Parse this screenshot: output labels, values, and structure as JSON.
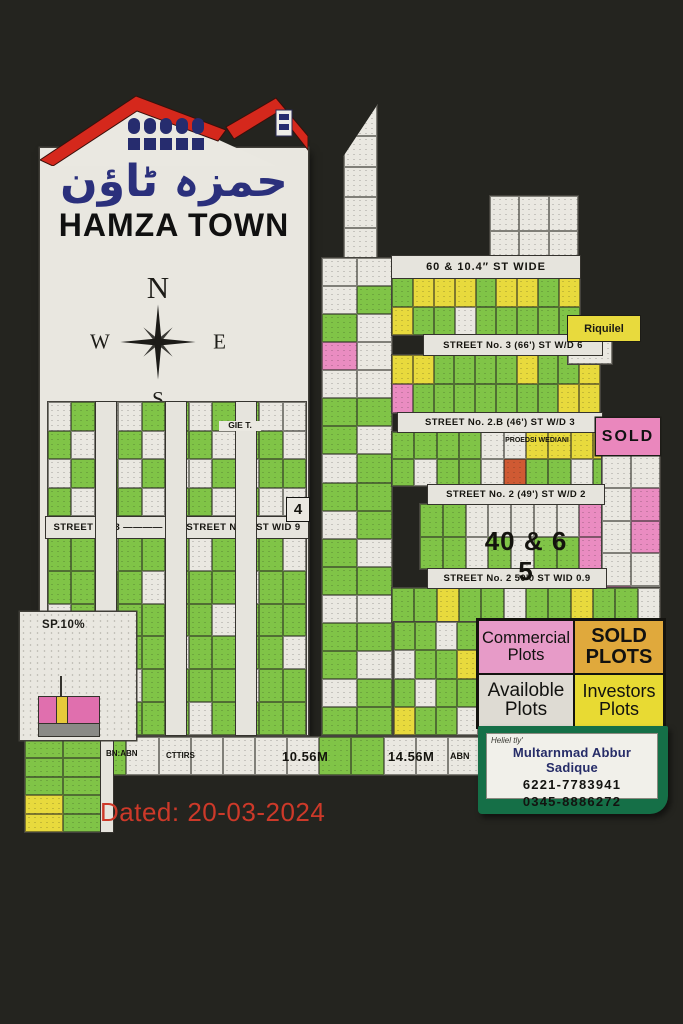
{
  "poster": {
    "dated": "Dated: 20-03-2024"
  },
  "logo": {
    "urdu": "حمزہ ٹاؤن",
    "title": "HAMZA TOWN"
  },
  "compass": {
    "n": "N",
    "e": "E",
    "s": "S",
    "w": "W"
  },
  "legend": {
    "commercial": "Commercial Plots",
    "sold": "SOLD PLOTS",
    "available": "Availoble Plots",
    "investors": "Investors Plots"
  },
  "sold_badge": "SOLD",
  "riquilel_label": "Riquilel",
  "sp10_label": "SP.10%",
  "contact": {
    "heading": "Heliel tly'",
    "name": "Multarnmad Abbur Sadique",
    "phone1": "6221-7783941",
    "phone2": "0345-8886272"
  },
  "palette": {
    "background": "#24241f",
    "paper": "#e9e7e0",
    "green_plot": "#80c447",
    "yellow_plot": "#e8da3d",
    "pink_plot": "#ea8cc1",
    "white_plot": "#eae8e1",
    "orange_red_plot": "#cf5a33",
    "legend_commercial_bg": "#e79bc8",
    "legend_sold_bg": "#e0a93c",
    "legend_available_bg": "#dedbd3",
    "legend_investors_bg": "#e8da33",
    "contact_green": "#156f47",
    "roof_red": "#d5281c",
    "logo_navy": "#2b307c",
    "dated_red": "#cd3929"
  },
  "street_bands": [
    {
      "name": "street-no3-band",
      "x": 46,
      "y": 517,
      "w": 262,
      "h": 21,
      "labels": [
        "STREET NO.3 ———— 8",
        "STREET NO.3  ST WID 9"
      ]
    },
    {
      "name": "street-60ft-band",
      "x": 392,
      "y": 256,
      "w": 188,
      "h": 22,
      "fs": 11,
      "labels": [
        "60 & 10.4″  ST WIDE"
      ]
    },
    {
      "name": "street-no3-66-band",
      "x": 424,
      "y": 335,
      "w": 178,
      "h": 20,
      "labels": [
        "STREET No. 3 (66')   ST W/D 6"
      ]
    },
    {
      "name": "street-no2b-band",
      "x": 398,
      "y": 413,
      "w": 204,
      "h": 19,
      "labels": [
        "STREET No. 2.B (46')   ST W/D 3"
      ]
    },
    {
      "name": "street-no2-band",
      "x": 428,
      "y": 485,
      "w": 176,
      "h": 19,
      "labels": [
        "STREET No. 2 (49')   ST W/D 2"
      ]
    },
    {
      "name": "street-no2-50-band",
      "x": 428,
      "y": 569,
      "w": 178,
      "h": 19,
      "labels": [
        "STREET No. 2 50'0   ST WID 0.9"
      ]
    },
    {
      "name": "left-vertical-street-1",
      "x": 96,
      "y": 402,
      "w": 20,
      "h": 333,
      "vertical": true,
      "labels": []
    },
    {
      "name": "left-vertical-street-2",
      "x": 166,
      "y": 402,
      "w": 20,
      "h": 333,
      "vertical": true,
      "labels": []
    },
    {
      "name": "left-vertical-street-3",
      "x": 236,
      "y": 402,
      "w": 20,
      "h": 333,
      "vertical": true,
      "labels": []
    },
    {
      "name": "bottom-left-street",
      "x": 101,
      "y": 740,
      "w": 12,
      "h": 92,
      "vertical": true,
      "labels": []
    }
  ],
  "float_labels": [
    {
      "name": "label-proposed-wedian",
      "text": "PROEDSI WEDIANI",
      "x": 498,
      "y": 437,
      "w": 78,
      "fs": 7
    },
    {
      "name": "label-40-65",
      "text": "40 & 6 5",
      "x": 476,
      "y": 527,
      "w": 100,
      "fs": 26,
      "ls": 1
    },
    {
      "name": "label-plot-4",
      "text": "4",
      "x": 286,
      "y": 497,
      "w": 22,
      "h": 23,
      "fs": 15,
      "bg": "#eae8e1",
      "border": true
    },
    {
      "name": "label-gie-t",
      "text": "GIE T.",
      "x": 219,
      "y": 421,
      "w": 42,
      "fs": 8.5,
      "bg": "#eae8e1"
    },
    {
      "name": "label-bn-abn",
      "text": "BN:ABN",
      "x": 106,
      "y": 749,
      "fs": 8
    },
    {
      "name": "label-cttirs",
      "text": "CTTIRS",
      "x": 166,
      "y": 751,
      "fs": 8
    },
    {
      "name": "label-10-56m",
      "text": "10.56M",
      "x": 282,
      "y": 750,
      "fs": 13,
      "ls": 0.5
    },
    {
      "name": "label-14-56m",
      "text": "14.56M",
      "x": 388,
      "y": 750,
      "fs": 13,
      "ls": 0.5
    },
    {
      "name": "label-abn",
      "text": "ABN",
      "x": 450,
      "y": 751,
      "fs": 9
    }
  ],
  "plot_blocks": [
    {
      "name": "left-upper-plots",
      "x": 48,
      "y": 402,
      "w": 258,
      "h": 114,
      "rows": [
        "W G W W G G W G G W W",
        "G W W G W G G W G G W",
        "W G G W G W W G W G G",
        "G W G G W G G W G W W"
      ]
    },
    {
      "name": "left-lower-plots",
      "x": 48,
      "y": 538,
      "w": 258,
      "h": 197,
      "rows": [
        "G G W G G G W G G G W",
        "G G G G W G G G W G G",
        "W G G G G G G W G G G",
        "G W G G G W G G G G W",
        "G G G W G G G G W G G",
        "G G G G G G W G G G G"
      ]
    },
    {
      "name": "tower-top-strip",
      "x": 343,
      "y": 104,
      "w": 33,
      "h": 154,
      "clip": "tower",
      "rows": [
        "W",
        "W",
        "W",
        "W",
        "W"
      ]
    },
    {
      "name": "tower-plots",
      "x": 322,
      "y": 258,
      "w": 70,
      "h": 477,
      "rows": [
        "W W",
        "W G",
        "G W",
        "P W",
        "W W",
        "G G",
        "G W",
        "W G",
        "G G",
        "W G",
        "G W",
        "G G",
        "W W",
        "G G",
        "G W",
        "W G",
        "G G"
      ]
    },
    {
      "name": "top-right-plots",
      "x": 490,
      "y": 196,
      "w": 88,
      "h": 70,
      "rows": [
        "W W W",
        "W W W"
      ]
    },
    {
      "name": "row-60ft-plots",
      "x": 392,
      "y": 278,
      "w": 188,
      "h": 57,
      "rows": [
        "G Y Y Y G Y Y G Y",
        "Y G G W G G G G G"
      ]
    },
    {
      "name": "street3-row-plots",
      "x": 392,
      "y": 355,
      "w": 208,
      "h": 58,
      "rows": [
        "Y Y G G G G Y G G Y",
        "P G G G G G G G Y Y"
      ]
    },
    {
      "name": "street2b-row-plots",
      "x": 392,
      "y": 432,
      "w": 268,
      "h": 54,
      "rows": [
        "G G G G W W Y Y Y Y W P",
        "G W G G W R G G W G G P"
      ]
    },
    {
      "name": "street2-row-plots",
      "x": 420,
      "y": 504,
      "w": 182,
      "h": 65,
      "rows": [
        "G G W W W W W P",
        "G G W G W G G P"
      ]
    },
    {
      "name": "right-edge-plots",
      "x": 602,
      "y": 455,
      "w": 58,
      "h": 164,
      "rows": [
        "W W",
        "W P",
        "W P",
        "W W",
        "P W"
      ]
    },
    {
      "name": "street250-row-plots",
      "x": 392,
      "y": 588,
      "w": 268,
      "h": 34,
      "rows": [
        "G G Y G G W G G Y G G W"
      ]
    },
    {
      "name": "lower-middle-plots",
      "x": 394,
      "y": 622,
      "w": 84,
      "h": 113,
      "rows": [
        "G G W G",
        "W G G Y",
        "G W G G",
        "Y G G W"
      ]
    },
    {
      "name": "bottom-strip-plots",
      "x": 30,
      "y": 737,
      "w": 450,
      "h": 38,
      "rows": [
        "G G G W W W W W W G G W W W"
      ]
    },
    {
      "name": "bottom-left-plots",
      "x": 25,
      "y": 740,
      "w": 76,
      "h": 92,
      "rows": [
        "G G",
        "G G",
        "G G",
        "Y G",
        "Y G"
      ]
    },
    {
      "name": "riquilel-under-plot",
      "x": 568,
      "y": 340,
      "w": 44,
      "h": 24,
      "rows": [
        "W"
      ]
    }
  ]
}
